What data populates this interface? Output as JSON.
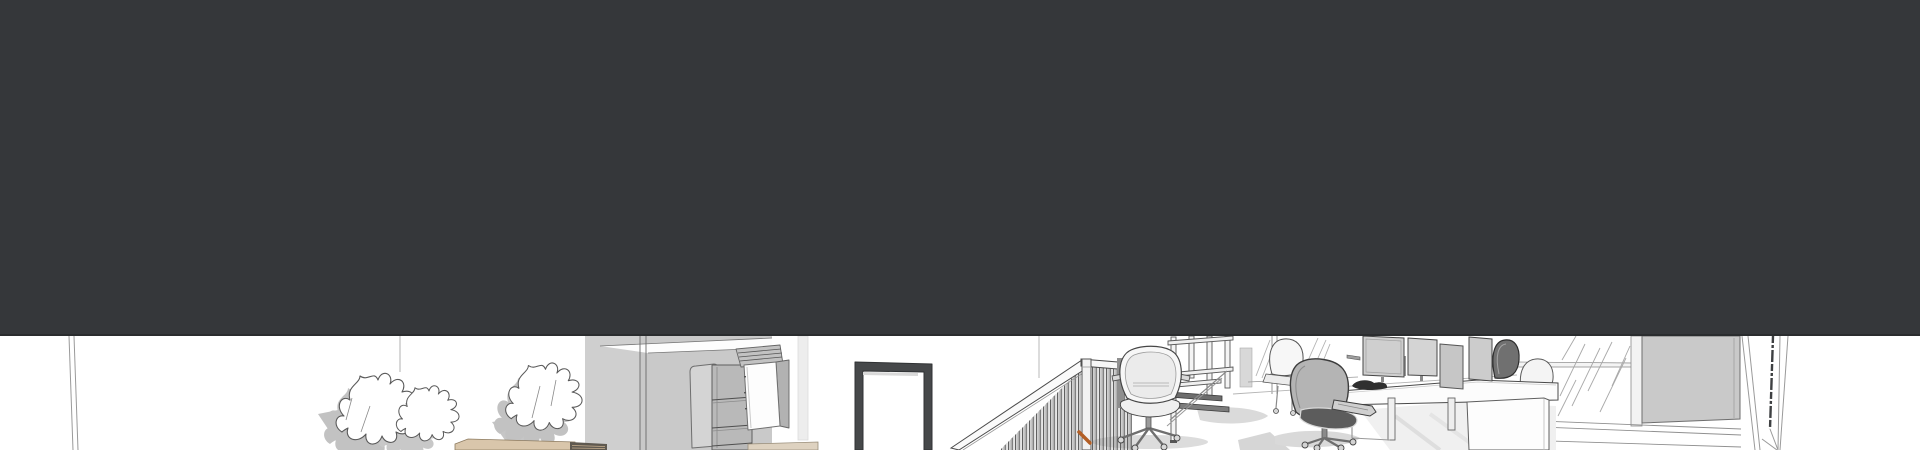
{
  "meta": {
    "type": "static screenshot, no text content",
    "width_px": 1920,
    "height_px": 450
  },
  "header": {
    "label": "dark header band (empty)",
    "background": "#35373a",
    "edge": "#2a2c2e",
    "height_px": 336
  },
  "illustration": {
    "label": "sketch-style 3D office interior rendering strip",
    "top_px": 336,
    "height_px": 114,
    "colors": {
      "background": "#ffffff",
      "outline": "#4a4a4a",
      "soft_outline": "#9a9a9a",
      "surface": "#c9c9c9",
      "surface_dark": "#b2b2b2",
      "panel": "#d4d4d4",
      "shadow": "#dcdcdc",
      "shadow_deep": "#c2c2c2",
      "white_object": "#f7f7f7",
      "door_frame": "#46484a",
      "tan": "#d9c6ab",
      "tan_dark": "#5f5950",
      "orange_accent": "#b35f26",
      "tread_dark": "#6d6d6d",
      "mesh_dark": "#5c5c5c",
      "desk_object_dark": "#2f2f2f"
    },
    "objects": [
      "left wall corner",
      "pendant cord",
      "potted plant left",
      "potted plant right",
      "wooden side table",
      "storage cabinet with open shelves",
      "open cabinet door",
      "louvered cabinet top",
      "dark door frame",
      "stair railing with balusters",
      "orange handrail accent",
      "newel post",
      "aeron office chair",
      "rolling platform ladder",
      "foreground office chair",
      "white office chair",
      "bench desk with monitors",
      "desk privacy dividers",
      "dark bag on desk",
      "under-desk pedestal",
      "window with glass hatching",
      "window blind panel",
      "window sill",
      "wall column with expansion joint",
      "floor shadows"
    ]
  }
}
